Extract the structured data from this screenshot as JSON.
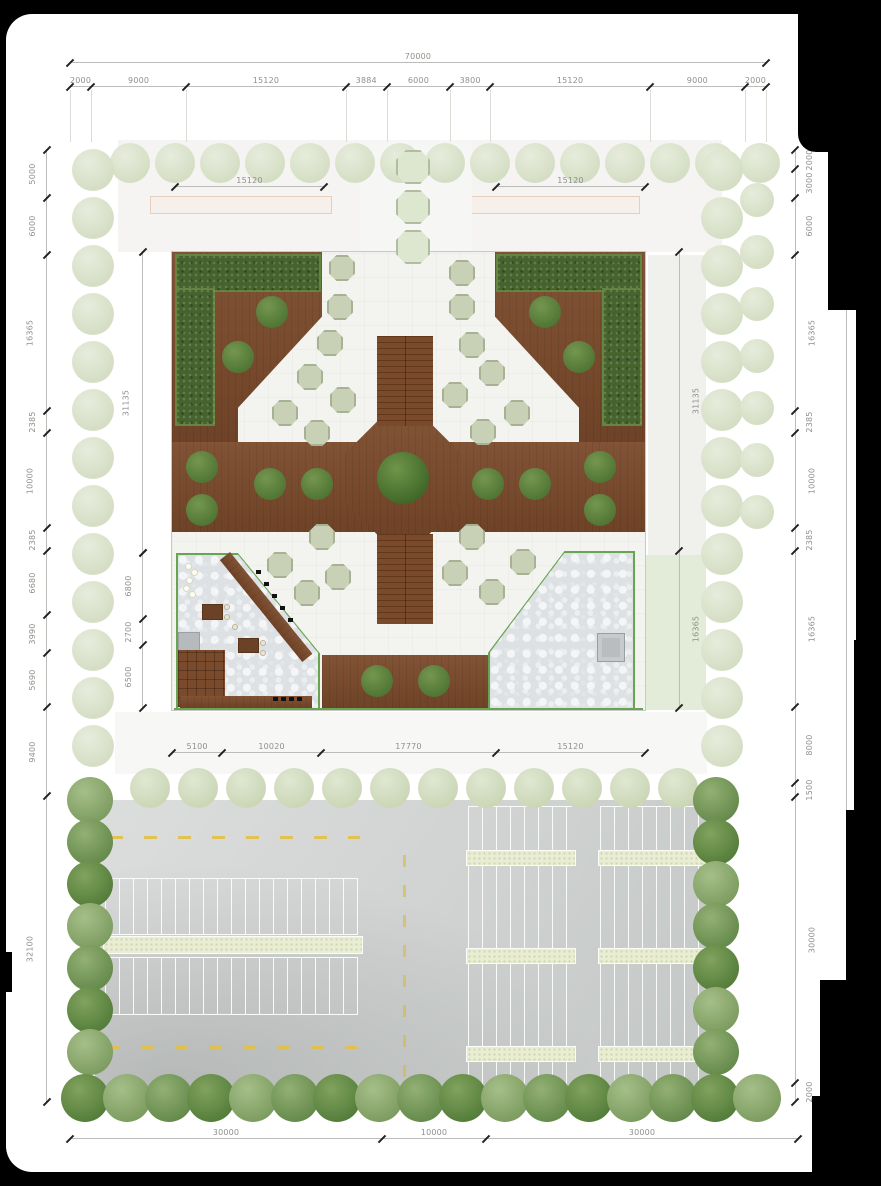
{
  "dims": {
    "top_total": [
      "70000"
    ],
    "top_chain": [
      "2000",
      "9000",
      "15120",
      "3884",
      "6000",
      "3800",
      "15120",
      "9000",
      "2000"
    ],
    "left_chain": [
      "5000",
      "6000",
      "16365",
      "2385",
      "10000",
      "2385",
      "6680",
      "3990",
      "5690",
      "9400",
      "32100"
    ],
    "right_chain": [
      "2000",
      "3000",
      "6000",
      "16365",
      "2385",
      "10000",
      "2385",
      "16365",
      "8000",
      "1500",
      "30000",
      "2000"
    ],
    "right_total": [
      "100000"
    ],
    "bottom_chain": [
      "30000",
      "10000",
      "30000"
    ],
    "plaza_top_left": [
      "15120"
    ],
    "plaza_top_right": [
      "15120"
    ],
    "plaza_bottom": [
      "5100",
      "10020",
      "17770",
      "15120"
    ],
    "plaza_left_upper": [
      "31135"
    ],
    "plaza_left_lower": [
      "6800",
      "2700",
      "6500"
    ],
    "plaza_right_side": [
      "31135",
      "16365"
    ]
  },
  "colors": {
    "deck_brown": "#7b4a2b",
    "hedge_green": "#46632e",
    "paving_white": "#f3f3f0",
    "gravel_gray": "#dde1e4",
    "border_green": "#69a452",
    "tree_dark": "#63894a",
    "tree_pale": "#dce4cc",
    "asphalt": "#d3d6d4",
    "marking_yellow": "#e4bf45"
  }
}
